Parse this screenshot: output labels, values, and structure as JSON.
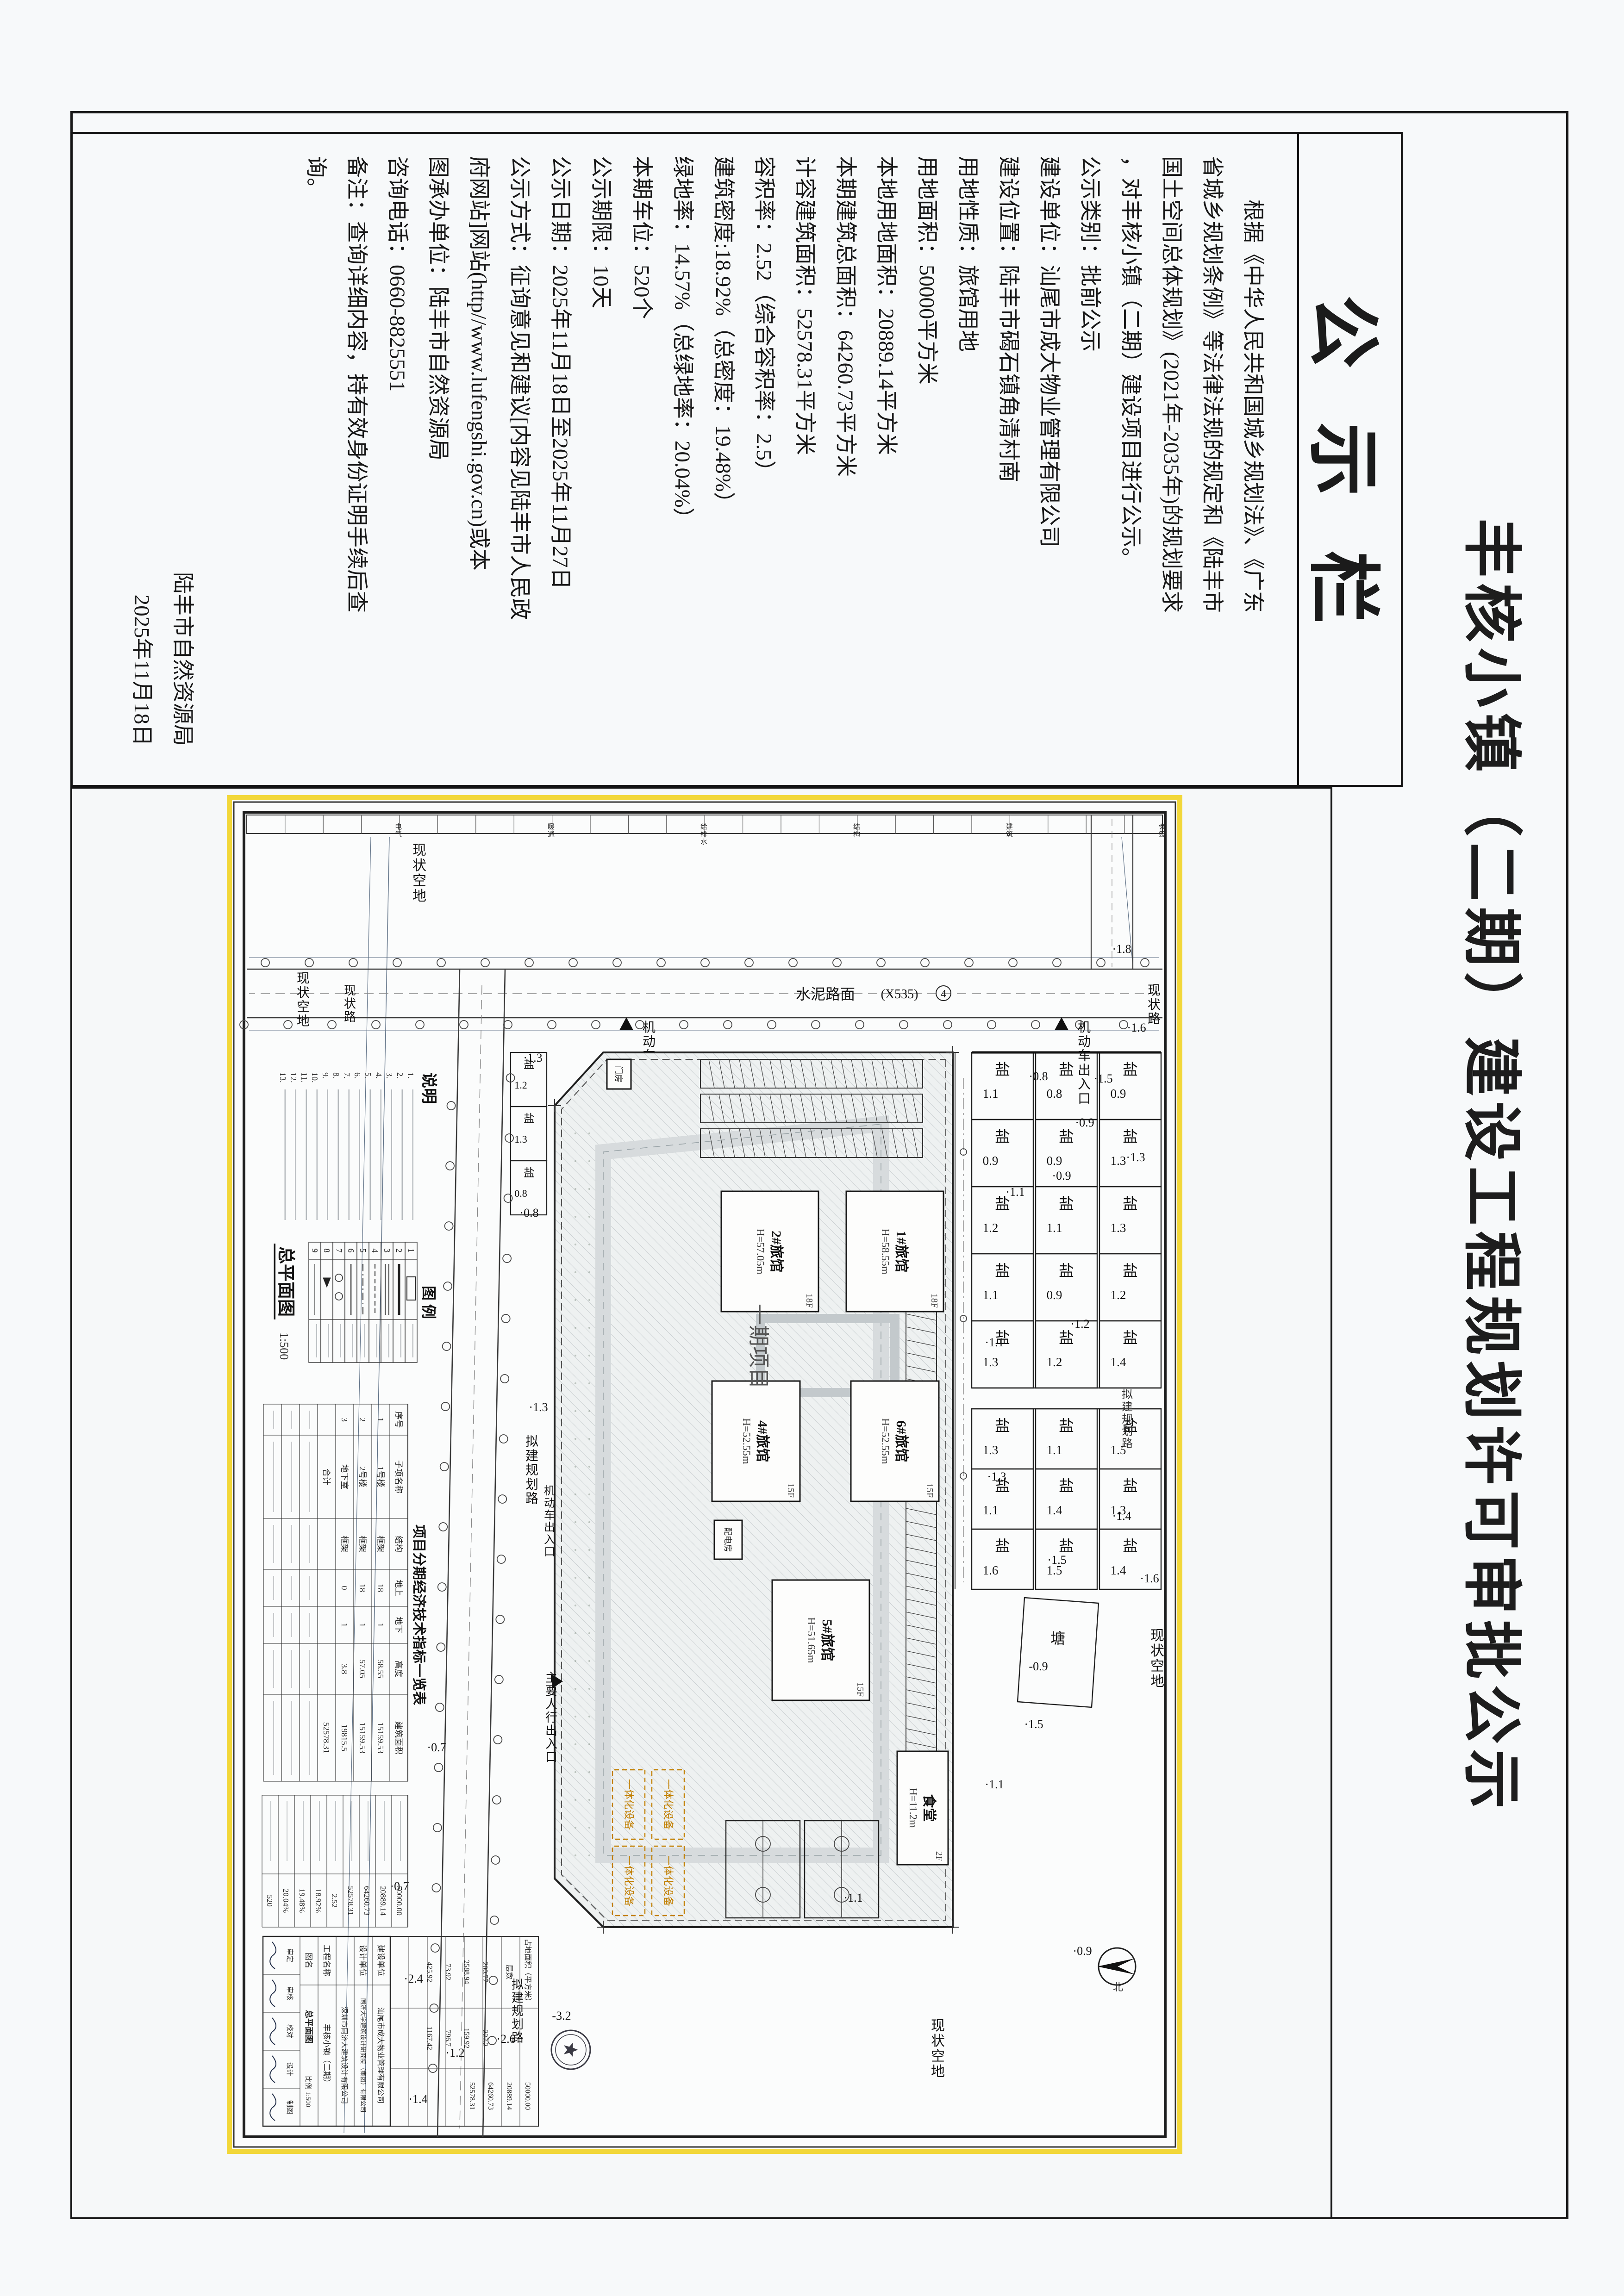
{
  "page": {
    "heading": "丰核小镇（二期）建设工程规划许可审批公示",
    "board_title": "公示栏"
  },
  "colors": {
    "plan_frame_yellow": "#f2d73a",
    "paper": "#f7f9fa",
    "ink": "#1b1b1b",
    "equipment_orange": "#c27f00"
  },
  "notice": {
    "lines": [
      {
        "t": "　　根据《中华人民共和国城乡规划法》、《广东"
      },
      {
        "t": "省城乡规划条例》等法律法规的规定和《陆丰市"
      },
      {
        "t": "国土空间总体规划》(2021年-2035年)的规划要求"
      },
      {
        "t": "，对丰核小镇（二期）建设项目进行公示。"
      },
      {
        "t": "公示类别：批前公示"
      },
      {
        "t": "建设单位：汕尾市成大物业管理有限公司"
      },
      {
        "t": "建设位置：陆丰市碣石镇角清村南"
      },
      {
        "t": "用地性质：旅馆用地"
      },
      {
        "t": "用地面积：50000平方米"
      },
      {
        "t": "本地用地面积：20889.14平方米"
      },
      {
        "t": "本期建筑总面积：64260.73平方米"
      },
      {
        "t": "计容建筑面积：52578.31平方米"
      },
      {
        "t": "容积率：2.52（综合容积率：2.5）"
      },
      {
        "t": "建筑密度:18.92%（总密度：19.48%）"
      },
      {
        "t": "绿地率：14.57%（总绿地率：20.04%）"
      },
      {
        "t": "本期车位：520个"
      },
      {
        "t": "公示期限：10天"
      },
      {
        "t": "公示日期：2025年11月18日至2025年11月27日"
      },
      {
        "t": "公示方式：征询意见和建议[内容见陆丰市人民政"
      },
      {
        "t": "府网站]网站(http//www.lufengshi.gov.cn)或本"
      },
      {
        "t": "图承办单位：陆丰市自然资源局"
      },
      {
        "t": "咨询电话：0660-8825551"
      },
      {
        "t": "备注：查询详细内容，持有效身份证明手续后查"
      },
      {
        "t": "询。"
      },
      {
        "t": "陆丰市自然资源局",
        "align": "right"
      },
      {
        "t": "2025年11月18日",
        "align": "right"
      }
    ]
  },
  "plan": {
    "empty_land": "现状空地",
    "existing_road": "现状路",
    "cement_road": "水泥路面",
    "road_code": "(X535)",
    "road_no": "4",
    "planned_road": "拟建规划路",
    "vehicle_entrance": "机动车出入口",
    "pedestrian_entrance": "主要人行出入口",
    "phase1": "一期项目",
    "pond": "塘",
    "pond_elev": "-0.9",
    "parcel": "盐",
    "equipment": "一体化设备",
    "notes_title": "说明",
    "legend_title": "图 例",
    "legend_nums": [
      "1",
      "2",
      "3",
      "4",
      "5",
      "6",
      "7",
      "8",
      "9"
    ],
    "note_nums": [
      "1.",
      "2.",
      "3.",
      "4.",
      "5.",
      "6.",
      "7.",
      "8.",
      "9.",
      "10.",
      "11.",
      "12.",
      "13."
    ],
    "drawing_name": "总平面图",
    "drawing_scale": "1:500",
    "buildings": [
      {
        "name": "1#旅馆",
        "height": "H=58.55m",
        "floors": "18F"
      },
      {
        "name": "2#旅馆",
        "height": "H=57.05m",
        "floors": "18F"
      },
      {
        "name": "6#旅馆",
        "height": "H=52.55m",
        "floors": "15F"
      },
      {
        "name": "4#旅馆",
        "height": "H=52.55m",
        "floors": "15F"
      },
      {
        "name": "5#旅馆",
        "height": "H=51.65m",
        "floors": "15F"
      },
      {
        "name": "食堂",
        "height": "H=11.2m",
        "floors": "2F"
      },
      {
        "name": "门房",
        "height": "",
        "floors": ""
      },
      {
        "name": "配电房",
        "height": "",
        "floors": ""
      }
    ],
    "parcel_rows": {
      "r1": [
        "0.9",
        "1.3",
        "1.3",
        "1.2",
        "1.4",
        "1.5",
        "1.3",
        "1.4"
      ],
      "r2": [
        "0.8",
        "0.9",
        "1.1",
        "0.9",
        "1.2",
        "1.1",
        "1.4",
        "1.5"
      ],
      "r3": [
        "1.1",
        "0.9",
        "1.2",
        "1.1",
        "1.3",
        "1.3",
        "1.1",
        "1.6"
      ],
      "south": [
        "1.2",
        "1.3",
        "0.8"
      ]
    },
    "elevations": [
      "1.8",
      "1.6",
      "1.5",
      "0.9",
      "0.9",
      "1.3",
      "0.8",
      "1.1",
      "1.2",
      "1.1",
      "1.4",
      "1.5",
      "1.3",
      "1.6",
      "1.1",
      "0.9",
      "1.5",
      "1.1",
      "1.3",
      "0.8",
      "1.3",
      "0.7",
      "0.7",
      "-3.2",
      "2.6",
      "1.2",
      "2.4",
      "1.4"
    ],
    "tables": {
      "econ_title": "项目分期经济技术指标一览表",
      "econ_head": [
        "序号",
        "子项名称",
        "结构",
        "地上",
        "地下",
        "高度",
        "建筑面积"
      ],
      "econ_rows": [
        [
          "1",
          "1号楼",
          "框架",
          "18",
          "1",
          "58.55",
          "15159.53"
        ],
        [
          "2",
          "2号楼",
          "框架",
          "18",
          "1",
          "57.05",
          "15159.53"
        ],
        [
          "3",
          "地下室",
          "框架",
          "0",
          "1",
          "3.8",
          "19815.5"
        ],
        [
          "",
          "合计",
          "",
          "",
          "",
          "",
          "52578.31"
        ]
      ],
      "metrics_vals": [
        "50000.00",
        "20889.14",
        "64260.73",
        "52578.31",
        "2.52",
        "18.92%",
        "19.48%",
        "20.04%",
        "520"
      ],
      "area_label1": "占地面积（平方米）",
      "area_label2": "层数",
      "area_vals": [
        "200.77",
        "222.2",
        "2588.94",
        "159.92",
        "73.92",
        "796.7",
        "425.92",
        "1167.42"
      ]
    },
    "titleblock": {
      "owner_label": "建设单位",
      "owner": "汕尾市成大物业管理有限公司",
      "designer_label": "设计单位",
      "designer1": "同济大学建筑设计研究院（集团）有限公司",
      "designer2": "深圳市同济人建筑设计有限公司",
      "project_label": "工程名称",
      "project": "丰核小镇（二期）",
      "drawing_label": "图名",
      "drawing": "总平面图",
      "scale_label": "比例",
      "scale": "1:500",
      "roles": [
        "审定",
        "审核",
        "校对",
        "设计",
        "制图"
      ]
    },
    "signoff_cells": [
      "会签",
      "建筑",
      "结构",
      "给排水",
      "暖通",
      "电气"
    ]
  }
}
